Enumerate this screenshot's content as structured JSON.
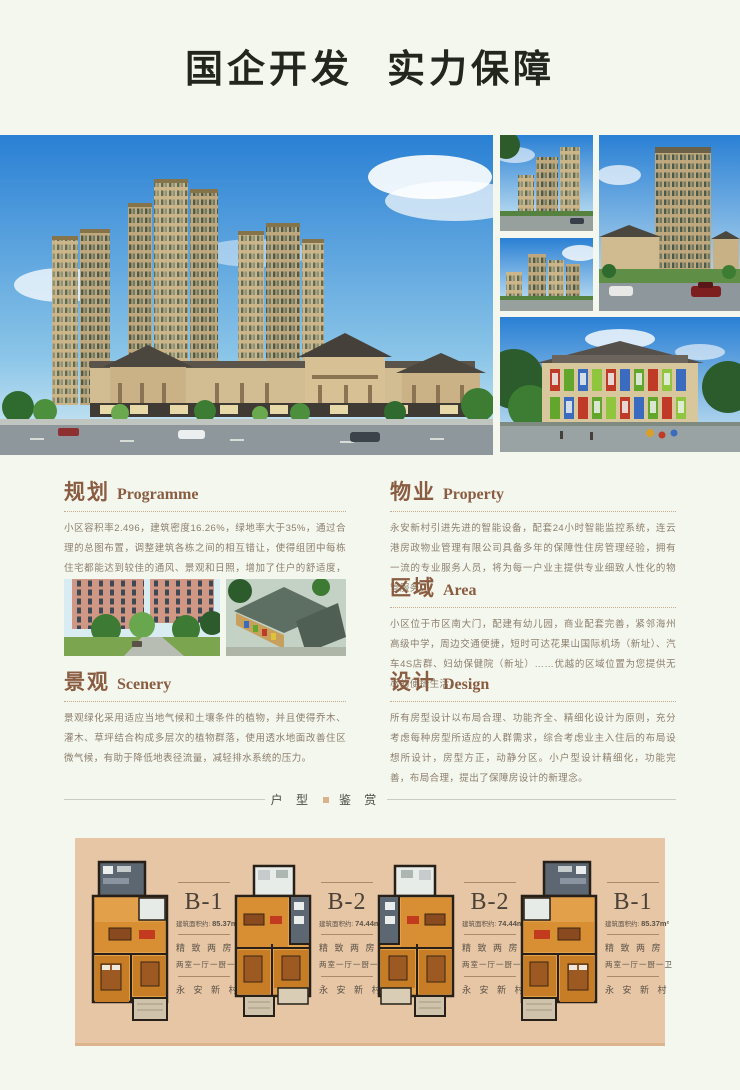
{
  "colors": {
    "page_bg": "#f3f7ee",
    "accent_brown": "#8a5c41",
    "panel_tan": "#e6c6a5",
    "body_text": "#8d7e6c"
  },
  "header": {
    "title_part1": "国企开发",
    "title_part2": "实力保障"
  },
  "sections": [
    {
      "zh": "规划",
      "en": "Programme",
      "body": "小区容积率2.496，建筑密度16.26%，绿地率大于35%，通过合理的总图布置，调整建筑各栋之间的相互错让，使得组团中每栋住宅都能达到较佳的通风、景观和日照，增加了住户的舒适度，减少了采暖和空调的能耗。"
    },
    {
      "zh": "物业",
      "en": "Property",
      "body": "永安新村引进先进的智能设备，配套24小时智能监控系统，连云港房政物业管理有限公司具备多年的保障性住房管理经验，拥有一流的专业服务人员，将为每一户业主提供专业细致人性化的物管服务。"
    },
    {
      "zh": "区域",
      "en": "Area",
      "body": "小区位于市区南大门，配建有幼儿园，商业配套完善，紧邻海州高级中学，周边交通便捷，短时可达花果山国际机场（新址）、汽车4S店群、妇幼保健院（新址）……优越的区域位置为您提供无尽的便捷生活。"
    },
    {
      "zh": "景观",
      "en": "Scenery",
      "body": "景观绿化采用适应当地气候和土壤条件的植物，并且使得乔木、灌木、草坪结合构成多层次的植物群落，使用透水地面改善住区微气候，有助于降低地表径流量，减轻排水系统的压力。"
    },
    {
      "zh": "设计",
      "en": "Design",
      "body": "所有房型设计以布局合理、功能齐全、精细化设计为原则，充分考虑每种房型所适应的人群需求，综合考虑业主入住后的布局设想所设计，房型方正，动静分区。小户型设计精细化，功能完善，布局合理，提出了保障房设计的新理念。"
    }
  ],
  "divider": {
    "label_left": "户 型",
    "label_right": "鉴 赏"
  },
  "floorplans": {
    "units": [
      {
        "name": "B-1",
        "area_label": "建筑面积约:",
        "area_value": "85.37m²",
        "type": "精 致 两 房",
        "layout": "两室一厅一厨一卫",
        "brand": "永 安 新 村"
      },
      {
        "name": "B-2",
        "area_label": "建筑面积约:",
        "area_value": "74.44m²",
        "type": "精 致 两 房",
        "layout": "两室一厅一厨一卫",
        "brand": "永 安 新 村"
      },
      {
        "name": "B-2",
        "area_label": "建筑面积约:",
        "area_value": "74.44m²",
        "type": "精 致 两 房",
        "layout": "两室一厅一厨一卫",
        "brand": "永 安 新 村"
      },
      {
        "name": "B-1",
        "area_label": "建筑面积约:",
        "area_value": "85.37m²",
        "type": "精 致 两 房",
        "layout": "两室一厅一厨一卫",
        "brand": "永 安 新 村"
      }
    ]
  }
}
